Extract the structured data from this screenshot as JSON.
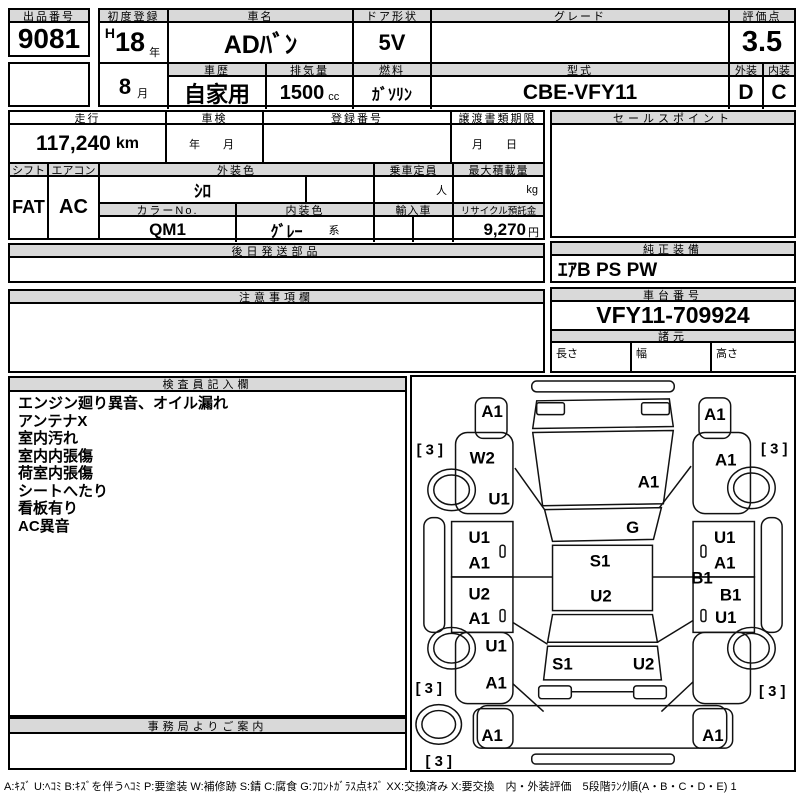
{
  "top": {
    "auction_label": "出品番号",
    "auction_no": "9081",
    "first_reg_label": "初度登録",
    "era_prefix": "H",
    "reg_year": "18",
    "year_unit": "年",
    "reg_month": "8",
    "month_unit": "月",
    "car_name_label": "車名",
    "car_name": "ADﾊﾞﾝ",
    "history_label": "車歴",
    "history": "自家用",
    "displacement_label": "排気量",
    "displacement": "1500",
    "displacement_unit": "cc",
    "door_label": "ドア形状",
    "door_shape": "5V",
    "fuel_label": "燃料",
    "fuel": "ｶﾞｿﾘﾝ",
    "grade_label": "グレード",
    "grade": "",
    "model_code_label": "型式",
    "model_code": "CBE-VFY11",
    "score_label": "評価点",
    "score": "3.5",
    "exterior_label": "外装",
    "exterior_grade": "D",
    "interior_label": "内装",
    "interior_grade": "C"
  },
  "mileage_row": {
    "mileage_label": "走行",
    "mileage": "117,240",
    "mileage_unit": "km",
    "inspection_label": "車検",
    "inspection_value": "年　月",
    "registration_label": "登録番号",
    "registration_value": "",
    "transfer_label": "譲渡書類期限",
    "transfer_value": "月　日"
  },
  "spec_row": {
    "shift_label": "シフト",
    "shift": "FAT",
    "aircon_label": "エアコン",
    "aircon": "AC",
    "exterior_color_label": "外装色",
    "exterior_color": "ｼﾛ",
    "capacity_label": "乗車定員",
    "capacity_unit": "人",
    "payload_label": "最大積載量",
    "payload_unit": "kg",
    "color_no_label": "カラーNo.",
    "color_no": "QM1",
    "interior_color_label": "内装色",
    "interior_color": "ｸﾞﾚｰ",
    "interior_color_unit": "系",
    "import_label": "輸入車",
    "recycle_label": "リサイクル預託金",
    "recycle_deposit": "9,270",
    "recycle_unit": "円"
  },
  "sales_point": {
    "label": "セールスポイント",
    "text": ""
  },
  "later_parts": {
    "label": "後日発送部品",
    "text": ""
  },
  "equipment": {
    "label": "純正装備",
    "text": "ｴｱB PS PW"
  },
  "caution": {
    "label": "注意事項欄",
    "text": ""
  },
  "chassis": {
    "label": "車台番号",
    "number": "VFY11-709924"
  },
  "dimensions": {
    "label": "諸元",
    "length_label": "長さ",
    "length": "",
    "width_label": "幅",
    "width": "",
    "height_label": "高さ",
    "height": ""
  },
  "inspector": {
    "label": "検査員記入欄",
    "notes": [
      "エンジン廻り異音、オイル漏れ",
      "アンテナX",
      "室内汚れ",
      "室内内張傷",
      "荷室内張傷",
      "シートへたり",
      "看板有り",
      "AC異音"
    ]
  },
  "office": {
    "label": "事務局よりご案内",
    "text": ""
  },
  "diagram": {
    "markers": [
      {
        "code": "A1",
        "x": 81,
        "y": 35
      },
      {
        "code": "A1",
        "x": 306,
        "y": 38
      },
      {
        "code": "W2",
        "x": 71,
        "y": 82
      },
      {
        "code": "A1",
        "x": 317,
        "y": 84
      },
      {
        "code": "U1",
        "x": 88,
        "y": 123
      },
      {
        "code": "A1",
        "x": 239,
        "y": 106
      },
      {
        "code": "G",
        "x": 223,
        "y": 152
      },
      {
        "code": "U1",
        "x": 68,
        "y": 162
      },
      {
        "code": "A1",
        "x": 68,
        "y": 188
      },
      {
        "code": "U1",
        "x": 316,
        "y": 162
      },
      {
        "code": "A1",
        "x": 316,
        "y": 188
      },
      {
        "code": "S1",
        "x": 190,
        "y": 186
      },
      {
        "code": "B1",
        "x": 293,
        "y": 203
      },
      {
        "code": "B1",
        "x": 322,
        "y": 220
      },
      {
        "code": "U2",
        "x": 68,
        "y": 219
      },
      {
        "code": "A1",
        "x": 68,
        "y": 244
      },
      {
        "code": "U2",
        "x": 191,
        "y": 221
      },
      {
        "code": "U1",
        "x": 317,
        "y": 243
      },
      {
        "code": "U1",
        "x": 85,
        "y": 272
      },
      {
        "code": "A1",
        "x": 85,
        "y": 309
      },
      {
        "code": "S1",
        "x": 152,
        "y": 290
      },
      {
        "code": "U2",
        "x": 234,
        "y": 290
      },
      {
        "code": "A1",
        "x": 81,
        "y": 362
      },
      {
        "code": "A1",
        "x": 304,
        "y": 362
      }
    ],
    "tires": [
      {
        "text": "[ 3 ]",
        "x": 18,
        "y": 74
      },
      {
        "text": "[ 3 ]",
        "x": 366,
        "y": 73
      },
      {
        "text": "[ 3 ]",
        "x": 17,
        "y": 315
      },
      {
        "text": "[ 3 ]",
        "x": 364,
        "y": 318
      },
      {
        "text": "[ 3 ]",
        "x": 27,
        "y": 389
      }
    ]
  },
  "legend": {
    "text": "A:ｷｽﾞ U:ﾍｺﾐ B:ｷｽﾞを伴うﾍｺﾐ P:要塗装 W:補修跡 S:錆 C:腐食 G:ﾌﾛﾝﾄｶﾞﾗｽ点ｷｽﾞ XX:交換済み X:要交換　内・外装評価　5段階ﾗﾝｸ順(A・B・C・D・E) 1"
  },
  "colors": {
    "header_bg": "#d9d9d9",
    "line": "#000000"
  }
}
